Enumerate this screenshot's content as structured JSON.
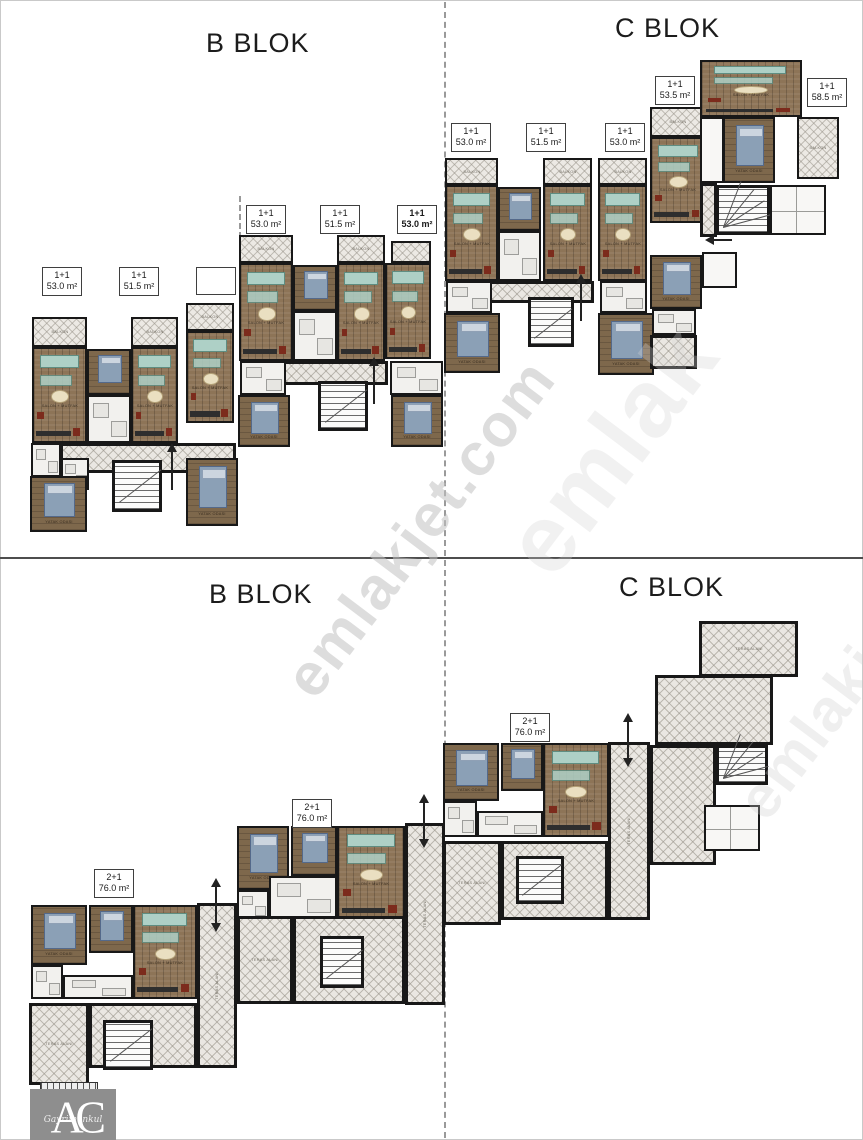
{
  "sheet": {
    "background": "#ffffff",
    "border_color": "#c9c9c9"
  },
  "top_floor": {
    "b_title": "B BLOK",
    "c_title": "C BLOK",
    "unit_labels": [
      {
        "type": "1+1",
        "area": "53.0 m²"
      },
      {
        "type": "1+1",
        "area": "51.5 m²"
      },
      {
        "type": "",
        "area": ""
      },
      {
        "type": "1+1",
        "area": "53.0 m²"
      },
      {
        "type": "1+1",
        "area": "51.5 m²"
      },
      {
        "type": "1+1",
        "area": "53.0 m²"
      },
      {
        "type": "1+1",
        "area": "53.0 m²"
      },
      {
        "type": "1+1",
        "area": "51.5 m²"
      },
      {
        "type": "1+1",
        "area": "53.0 m²"
      },
      {
        "type": "1+1",
        "area": "53.5 m²"
      },
      {
        "type": "1+1",
        "area": "58.5 m²"
      }
    ]
  },
  "bottom_floor": {
    "b_title": "B BLOK",
    "c_title": "C BLOK",
    "unit_labels": [
      {
        "type": "2+1",
        "area": "76.0 m²"
      },
      {
        "type": "2+1",
        "area": "76.0 m²"
      },
      {
        "type": "2+1",
        "area": "76.0 m²"
      }
    ]
  },
  "watermark": {
    "text": "emlakjet.com",
    "text_short": "emlak"
  },
  "logo": {
    "monogram": "AC",
    "script": "Gayrimenkul"
  },
  "plan_texts": {
    "living": "SALON + MUTFAK",
    "bedroom": "YATAK ODASI",
    "balcony": "BALKON",
    "terrace": "TERAS ALANI"
  },
  "plan_colors": {
    "wall": "#181818",
    "wood_floor": "#8d7457",
    "tile_hatch": "#eae7e2",
    "sofa": "#aed0c6",
    "bed": "#8ba0b6",
    "accent_red": "#7c2b1c"
  }
}
